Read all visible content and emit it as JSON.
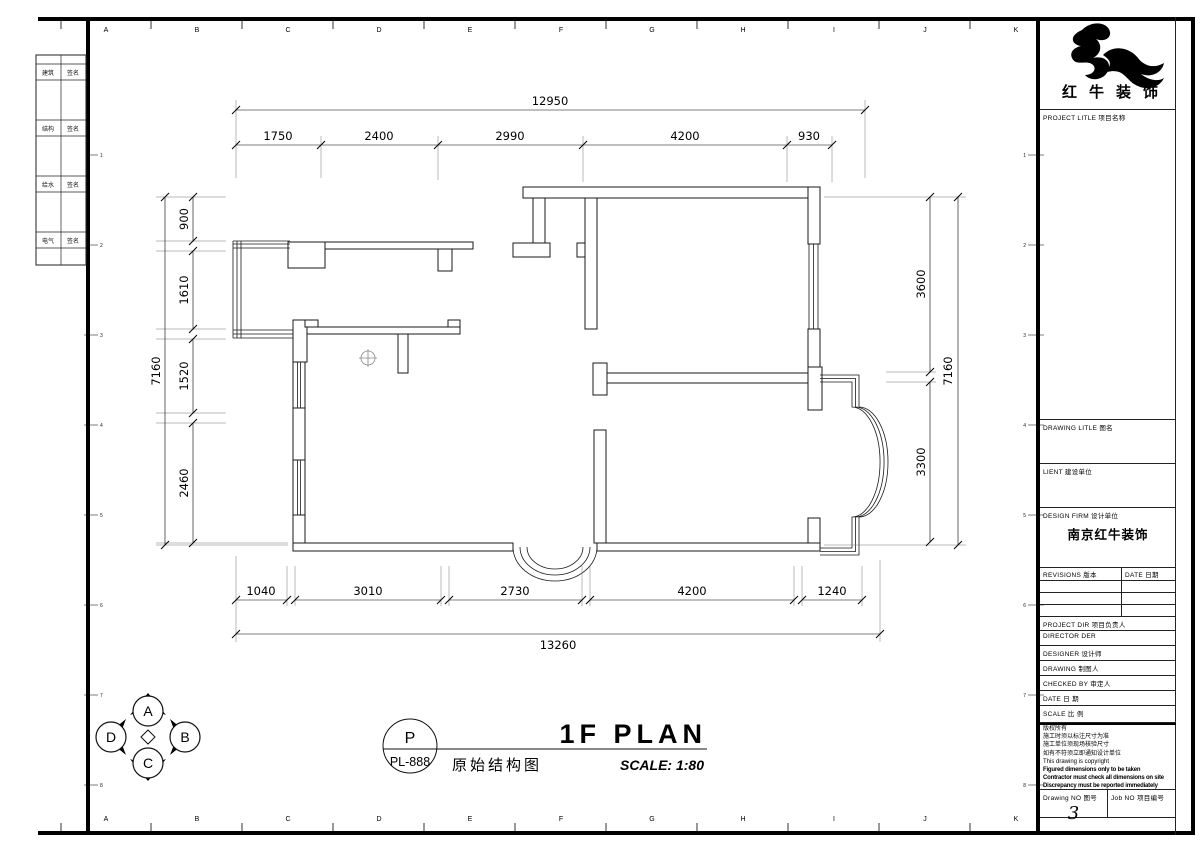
{
  "sheet": {
    "grid_letters": [
      "A",
      "B",
      "C",
      "D",
      "E",
      "F",
      "G",
      "H",
      "I",
      "J",
      "K"
    ],
    "zone_numbers": [
      "1",
      "2",
      "3",
      "4",
      "5",
      "6",
      "7",
      "8"
    ]
  },
  "fold_strip": {
    "rows": [
      {
        "c1": "建筑",
        "c2": "签名"
      },
      {
        "c1": "结构",
        "c2": "签名"
      },
      {
        "c1": "给水",
        "c2": "签名"
      },
      {
        "c1": "电气",
        "c2": "签名"
      }
    ]
  },
  "plan": {
    "dims": {
      "top_total": "12950",
      "top_segments": [
        "1750",
        "2400",
        "2990",
        "4200",
        "930"
      ],
      "left_total": "7160",
      "left_segments": [
        "900",
        "1610",
        "1520",
        "2460"
      ],
      "right_total": "7160",
      "right_segments": [
        "3600",
        "3300"
      ],
      "bottom_total": "13260",
      "bottom_segments": [
        "1040",
        "3010",
        "2730",
        "4200",
        "1240"
      ]
    }
  },
  "titlebar": {
    "circle_top": "P",
    "circle_bottom": "PL-888",
    "title_en": "1F PLAN",
    "title_cn": "原始结构图",
    "scale_text": "SCALE: 1:80",
    "compass": [
      "A",
      "B",
      "C",
      "D"
    ]
  },
  "titleblock": {
    "brand": "红牛装饰",
    "labels": {
      "project_title": "PROJECT LITLE  项目名称",
      "drawing_title": "DRAWING LITLE  图名",
      "client": "LIENT  建设单位",
      "design_firm": "DESIGN FIRM  设计单位",
      "revisions": "REVISIONS  版本",
      "rev_date": "DATE  日期",
      "project_dir": "PROJECT DIR  项目负责人",
      "director": "DIRECTOR DER",
      "designer": "DESIGNER  设计师",
      "drawing": "DRAWING  制图人",
      "checked": "CHECKED BY  审定人",
      "date": "DATE  日 期",
      "scale": "SCALE  比 例",
      "drawing_no": "Drawing NO  图号",
      "job_no": "Job NO  项目编号"
    },
    "values": {
      "design_firm": "南京红牛装饰",
      "drawing_no": "3"
    },
    "notes": [
      "版权所有",
      "施工时须以标注尺寸为准",
      "施工单位须现场核验尺寸",
      "如有不符须立即通知设计单位",
      "This drawing is copyright",
      "Figured dimensions only to be taken",
      "Contractor must check all dimensions on site",
      "Discrepancy must be reported immediately"
    ]
  }
}
